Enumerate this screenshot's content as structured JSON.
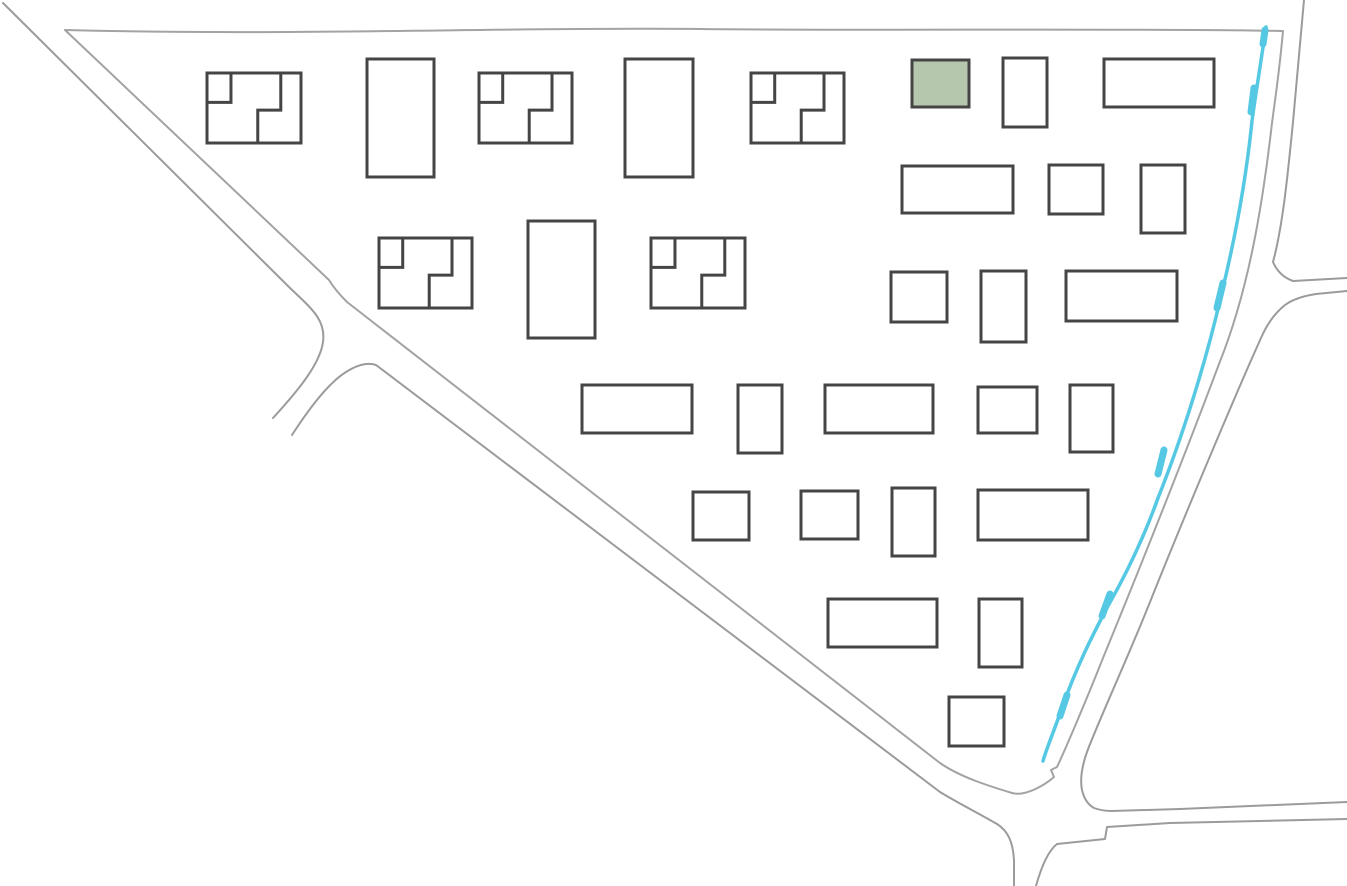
{
  "map": {
    "canvas": {
      "width": 1347,
      "height": 886,
      "background": "#ffffff"
    },
    "colors": {
      "building_stroke": "#454545",
      "building_fill": "#ffffff",
      "highlight_fill": "#b5c8ad",
      "road_stroke": "#9b9b9b",
      "boundary_stroke": "#a3a3a3",
      "river": "#55c8e3"
    },
    "stroke_widths": {
      "building": 3,
      "road": 2,
      "river_main": 3.5,
      "river_bulge": 7
    },
    "highlighted_building": {
      "x": 912,
      "y": 60,
      "w": 57,
      "h": 47,
      "fill": "#b5c8ad",
      "selected": true
    },
    "buildings": [
      {
        "type": "duplex",
        "x": 207,
        "y": 73,
        "w": 94,
        "h": 70
      },
      {
        "type": "rect",
        "x": 367,
        "y": 59,
        "w": 67,
        "h": 118
      },
      {
        "type": "duplex",
        "x": 479,
        "y": 73,
        "w": 93,
        "h": 70
      },
      {
        "type": "rect",
        "x": 625,
        "y": 59,
        "w": 68,
        "h": 118
      },
      {
        "type": "duplex",
        "x": 751,
        "y": 73,
        "w": 93,
        "h": 70
      },
      {
        "type": "rect",
        "x": 912,
        "y": 60,
        "w": 57,
        "h": 47,
        "highlight": true
      },
      {
        "type": "rect",
        "x": 1003,
        "y": 58,
        "w": 44,
        "h": 69
      },
      {
        "type": "rect",
        "x": 1104,
        "y": 59,
        "w": 110,
        "h": 48
      },
      {
        "type": "rect",
        "x": 902,
        "y": 166,
        "w": 111,
        "h": 47
      },
      {
        "type": "rect",
        "x": 1049,
        "y": 165,
        "w": 54,
        "h": 49
      },
      {
        "type": "rect",
        "x": 1141,
        "y": 165,
        "w": 44,
        "h": 68
      },
      {
        "type": "duplex",
        "x": 379,
        "y": 238,
        "w": 93,
        "h": 70
      },
      {
        "type": "rect",
        "x": 528,
        "y": 221,
        "w": 67,
        "h": 117
      },
      {
        "type": "duplex",
        "x": 651,
        "y": 238,
        "w": 94,
        "h": 70
      },
      {
        "type": "rect",
        "x": 891,
        "y": 272,
        "w": 56,
        "h": 50
      },
      {
        "type": "rect",
        "x": 981,
        "y": 271,
        "w": 45,
        "h": 71
      },
      {
        "type": "rect",
        "x": 1066,
        "y": 271,
        "w": 111,
        "h": 50
      },
      {
        "type": "rect",
        "x": 582,
        "y": 385,
        "w": 110,
        "h": 48
      },
      {
        "type": "rect",
        "x": 738,
        "y": 385,
        "w": 44,
        "h": 68
      },
      {
        "type": "rect",
        "x": 825,
        "y": 385,
        "w": 108,
        "h": 48
      },
      {
        "type": "rect",
        "x": 978,
        "y": 387,
        "w": 59,
        "h": 46
      },
      {
        "type": "rect",
        "x": 1070,
        "y": 385,
        "w": 43,
        "h": 67
      },
      {
        "type": "rect",
        "x": 693,
        "y": 492,
        "w": 56,
        "h": 48
      },
      {
        "type": "rect",
        "x": 801,
        "y": 491,
        "w": 57,
        "h": 48
      },
      {
        "type": "rect",
        "x": 892,
        "y": 488,
        "w": 43,
        "h": 68
      },
      {
        "type": "rect",
        "x": 978,
        "y": 490,
        "w": 110,
        "h": 50
      },
      {
        "type": "rect",
        "x": 828,
        "y": 599,
        "w": 109,
        "h": 48
      },
      {
        "type": "rect",
        "x": 979,
        "y": 599,
        "w": 43,
        "h": 68
      },
      {
        "type": "rect",
        "x": 949,
        "y": 697,
        "w": 55,
        "h": 49
      }
    ],
    "duplex_partition": {
      "unit1": [
        [
          0,
          0.42
        ],
        [
          0.255,
          0.42
        ],
        [
          0.255,
          0
        ]
      ],
      "unit2": [
        [
          0.785,
          0
        ],
        [
          0.785,
          0.53
        ],
        [
          0.54,
          0.53
        ],
        [
          0.54,
          1
        ]
      ]
    },
    "roads": {
      "boundary_loop": "M 65,30 C 300,36 500,27 700,29 C 900,31 1100,28 1283,31 C 1279,75 1275,100 1272,123 C 1262,210 1248,292 1219,364 C 1186,452 1148,548 1103,658 C 1088,696 1066,748 1057,767 l -6,3 3,7 C 1046,784 1026,797 1012,793 C 989,786 960,777 940,763 L 347,302 Q 335,290 329,280 Z",
      "paths": [
        "M 3,3 L 290,288 C 312,309 326,320 323,342 C 320,365 295,394 273,418",
        "M 292,435 C 312,404 330,382 346,372 C 357,365 367,362 376,365 L 940,792 C 958,803 978,813 997,824 C 1008,831 1013,842 1014,860 L 1014,886",
        "M 1304,0 C 1299,55 1296,90 1293,122 C 1288,172 1283,225 1273,262 Q 1279,276 1293,281 L 1347,278",
        "M 1347,291 L 1316,294 Q 1296,297 1285,305 Q 1270,317 1261,338 C 1242,380 1195,490 1152,597 C 1130,653 1098,722 1087,752 C 1082,766 1080,780 1082,790 Q 1085,803 1094,808 Q 1102,811 1112,811 L 1180,809 L 1347,802",
        "M 1347,819 L 1170,823 L 1107,827 L 1105,839 L 1057,844 C 1048,851 1041,868 1036,886"
      ]
    },
    "river": {
      "main": "M 1266,27 C 1259,75 1255,98 1252,121 C 1246,180 1236,235 1221,296 C 1206,362 1182,438 1158,498 C 1143,540 1124,578 1108,606 C 1092,636 1076,668 1062,708 C 1054,731 1046,750 1043,761",
      "bulges": [
        "M 1265,30 L 1263,44",
        "M 1254,88 L 1251,112",
        "M 1223,283 L 1217,308",
        "M 1164,450 L 1158,474",
        "M 1110,594 L 1102,616",
        "M 1067,695 L 1060,716"
      ]
    }
  }
}
